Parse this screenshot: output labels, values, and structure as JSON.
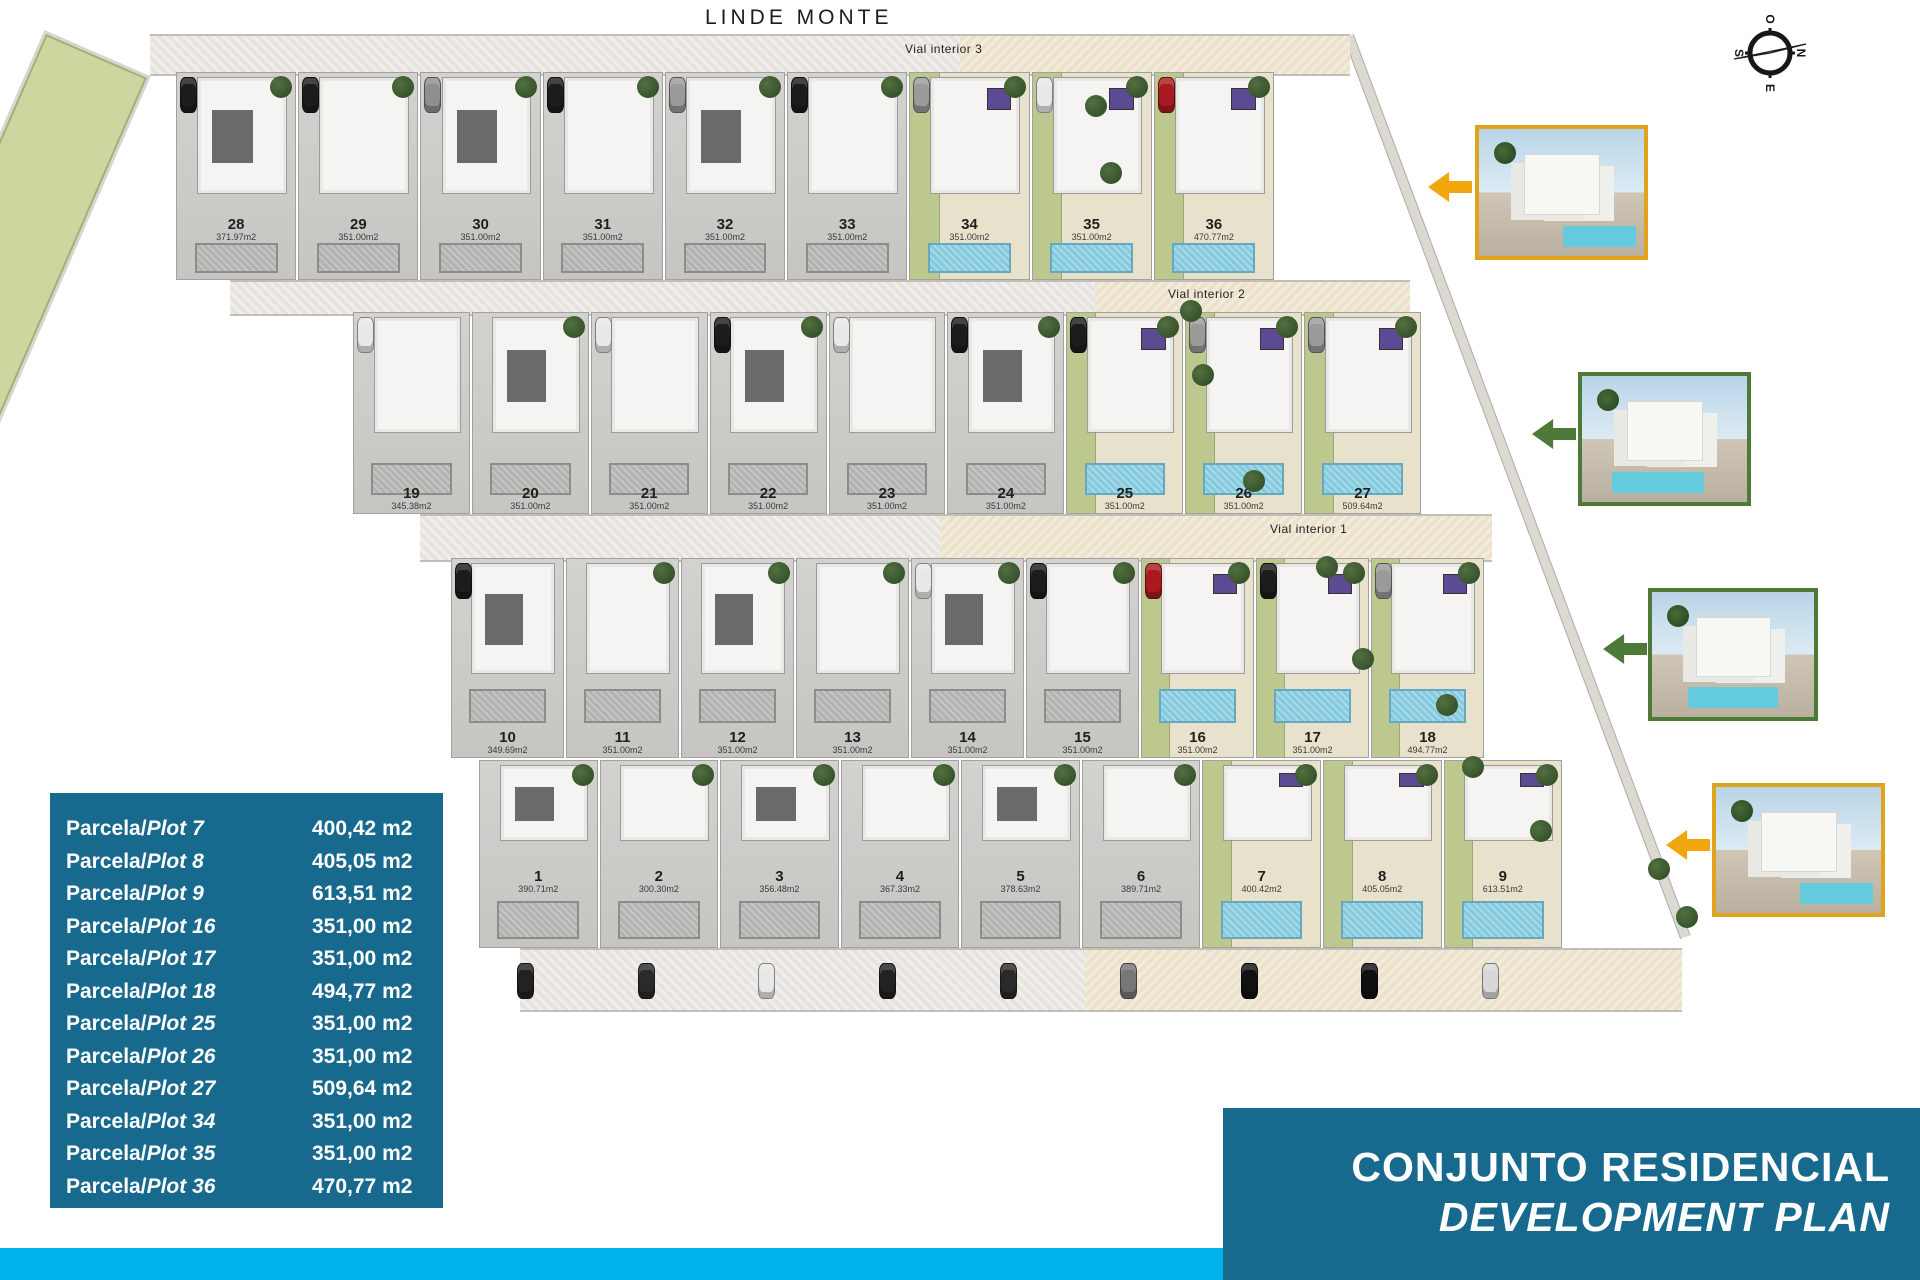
{
  "page": {
    "site_title": "LINDE MONTE",
    "bottom_title_line1": "CONJUNTO RESIDENCIAL",
    "bottom_title_line2": "DEVELOPMENT PLAN"
  },
  "compass": {
    "top": "O",
    "right": "N",
    "bottom": "E",
    "left": "S"
  },
  "roads": {
    "vial3": "Vial interior 3",
    "vial2": "Vial interior 2",
    "vial1": "Vial interior 1"
  },
  "colors": {
    "legend_bg": "#17698E",
    "accent_strip": "#00B3EA",
    "pool_blue": "#84CADE",
    "lawn_green": "#BCC88D",
    "highlight_ground": "#E8E1CC",
    "photo_border_amber": "#DFA31D",
    "photo_border_green": "#4E7A39",
    "arrow_amber": "#F2A60D",
    "arrow_green": "#4E7A39"
  },
  "plan": {
    "rows": [
      {
        "id": "row-28-36",
        "plots": [
          {
            "number": "28",
            "area": "371.97m2",
            "highlight": false,
            "dark": true,
            "car": "#1c1c1c",
            "tree": true
          },
          {
            "number": "29",
            "area": "351.00m2",
            "highlight": false,
            "dark": false,
            "car": "#1c1c1c",
            "tree": true
          },
          {
            "number": "30",
            "area": "351.00m2",
            "highlight": false,
            "dark": true,
            "car": "#8f8f8f",
            "tree": true
          },
          {
            "number": "31",
            "area": "351.00m2",
            "highlight": false,
            "dark": false,
            "car": "#1c1c1c",
            "tree": true
          },
          {
            "number": "32",
            "area": "351.00m2",
            "highlight": false,
            "dark": true,
            "car": "#9a9a9a",
            "tree": true
          },
          {
            "number": "33",
            "area": "351.00m2",
            "highlight": false,
            "dark": false,
            "car": "#1c1c1c",
            "tree": true
          },
          {
            "number": "34",
            "area": "351.00m2",
            "highlight": true,
            "dark": false,
            "car": "#9a9a9a",
            "tree": true
          },
          {
            "number": "35",
            "area": "351.00m2",
            "highlight": true,
            "dark": false,
            "car": "#e8e8e8",
            "tree": true
          },
          {
            "number": "36",
            "area": "470.77m2",
            "highlight": true,
            "dark": false,
            "car": "#a81a20",
            "tree": true
          }
        ]
      },
      {
        "id": "row-19-27",
        "plots": [
          {
            "number": "19",
            "area": "345.38m2",
            "highlight": false,
            "dark": false,
            "car": "#e8e8e8",
            "tree": false
          },
          {
            "number": "20",
            "area": "351.00m2",
            "highlight": false,
            "dark": true,
            "car": null,
            "tree": true
          },
          {
            "number": "21",
            "area": "351.00m2",
            "highlight": false,
            "dark": false,
            "car": "#e8e8e8",
            "tree": false
          },
          {
            "number": "22",
            "area": "351.00m2",
            "highlight": false,
            "dark": true,
            "car": "#1c1c1c",
            "tree": true
          },
          {
            "number": "23",
            "area": "351.00m2",
            "highlight": false,
            "dark": false,
            "car": "#e8e8e8",
            "tree": false
          },
          {
            "number": "24",
            "area": "351.00m2",
            "highlight": false,
            "dark": true,
            "car": "#1c1c1c",
            "tree": true
          },
          {
            "number": "25",
            "area": "351.00m2",
            "highlight": true,
            "dark": false,
            "car": "#1c1c1c",
            "tree": true
          },
          {
            "number": "26",
            "area": "351.00m2",
            "highlight": true,
            "dark": false,
            "car": "#9a9a9a",
            "tree": true
          },
          {
            "number": "27",
            "area": "509.64m2",
            "highlight": true,
            "dark": false,
            "car": "#9a9a9a",
            "tree": true
          }
        ]
      },
      {
        "id": "row-10-18",
        "plots": [
          {
            "number": "10",
            "area": "349.69m2",
            "highlight": false,
            "dark": true,
            "car": "#1c1c1c",
            "tree": false
          },
          {
            "number": "11",
            "area": "351.00m2",
            "highlight": false,
            "dark": false,
            "car": null,
            "tree": true
          },
          {
            "number": "12",
            "area": "351.00m2",
            "highlight": false,
            "dark": true,
            "car": null,
            "tree": true
          },
          {
            "number": "13",
            "area": "351.00m2",
            "highlight": false,
            "dark": false,
            "car": null,
            "tree": true
          },
          {
            "number": "14",
            "area": "351.00m2",
            "highlight": false,
            "dark": true,
            "car": "#e8e8e8",
            "tree": true
          },
          {
            "number": "15",
            "area": "351.00m2",
            "highlight": false,
            "dark": false,
            "car": "#1c1c1c",
            "tree": true
          },
          {
            "number": "16",
            "area": "351.00m2",
            "highlight": true,
            "dark": false,
            "car": "#a81a20",
            "tree": true
          },
          {
            "number": "17",
            "area": "351.00m2",
            "highlight": true,
            "dark": false,
            "car": "#1c1c1c",
            "tree": true
          },
          {
            "number": "18",
            "area": "494.77m2",
            "highlight": true,
            "dark": false,
            "car": "#9a9a9a",
            "tree": true
          }
        ]
      },
      {
        "id": "row-1-9",
        "plots": [
          {
            "number": "1",
            "area": "390.71m2",
            "highlight": false,
            "dark": true,
            "car": null,
            "car_bottom": "#222222",
            "tree": true
          },
          {
            "number": "2",
            "area": "300.30m2",
            "highlight": false,
            "dark": false,
            "car": null,
            "car_bottom": "#2a2a2a",
            "tree": true
          },
          {
            "number": "3",
            "area": "356.48m2",
            "highlight": false,
            "dark": true,
            "car": null,
            "car_bottom": "#e8e8e8",
            "tree": true
          },
          {
            "number": "4",
            "area": "367.33m2",
            "highlight": false,
            "dark": false,
            "car": null,
            "car_bottom": "#222222",
            "tree": true
          },
          {
            "number": "5",
            "area": "378.63m2",
            "highlight": false,
            "dark": true,
            "car": null,
            "car_bottom": "#2a2a2a",
            "tree": true
          },
          {
            "number": "6",
            "area": "389.71m2",
            "highlight": false,
            "dark": false,
            "car": null,
            "car_bottom": "#777777",
            "tree": true
          },
          {
            "number": "7",
            "area": "400.42m2",
            "highlight": true,
            "dark": false,
            "car": null,
            "car_bottom": "#111111",
            "tree": true
          },
          {
            "number": "8",
            "area": "405.05m2",
            "highlight": true,
            "dark": false,
            "car": null,
            "car_bottom": "#101010",
            "tree": true
          },
          {
            "number": "9",
            "area": "613.51m2",
            "highlight": true,
            "dark": false,
            "car": null,
            "car_bottom": "#d8d8d8",
            "tree": true
          }
        ]
      }
    ]
  },
  "legend": {
    "rows": [
      {
        "prefix": "Parcela/",
        "plot": "Plot 7",
        "value": "400,42 m2"
      },
      {
        "prefix": "Parcela/",
        "plot": "Plot 8",
        "value": "405,05 m2"
      },
      {
        "prefix": "Parcela/",
        "plot": "Plot 9",
        "value": "613,51 m2"
      },
      {
        "prefix": "Parcela/",
        "plot": "Plot 16",
        "value": "351,00 m2"
      },
      {
        "prefix": "Parcela/",
        "plot": "Plot 17",
        "value": "351,00 m2"
      },
      {
        "prefix": "Parcela/",
        "plot": "Plot 18",
        "value": "494,77 m2"
      },
      {
        "prefix": "Parcela/",
        "plot": "Plot 25",
        "value": "351,00 m2"
      },
      {
        "prefix": "Parcela/",
        "plot": "Plot 26",
        "value": "351,00 m2"
      },
      {
        "prefix": "Parcela/",
        "plot": "Plot 27",
        "value": "509,64 m2"
      },
      {
        "prefix": "Parcela/",
        "plot": "Plot 34",
        "value": "351,00 m2"
      },
      {
        "prefix": "Parcela/",
        "plot": "Plot 35",
        "value": "351,00 m2"
      },
      {
        "prefix": "Parcela/",
        "plot": "Plot 36",
        "value": "470,77 m2"
      }
    ]
  },
  "photos": [
    {
      "name": "villa-photo-top",
      "border": "#DFA31D",
      "arrow": "#F2A60D"
    },
    {
      "name": "villa-photo-upper-middle",
      "border": "#4E7A39",
      "arrow": "#4E7A39"
    },
    {
      "name": "villa-photo-lower-middle",
      "border": "#4E7A39",
      "arrow": "#4E7A39"
    },
    {
      "name": "villa-photo-bottom",
      "border": "#DFA31D",
      "arrow": "#F2A60D"
    }
  ]
}
